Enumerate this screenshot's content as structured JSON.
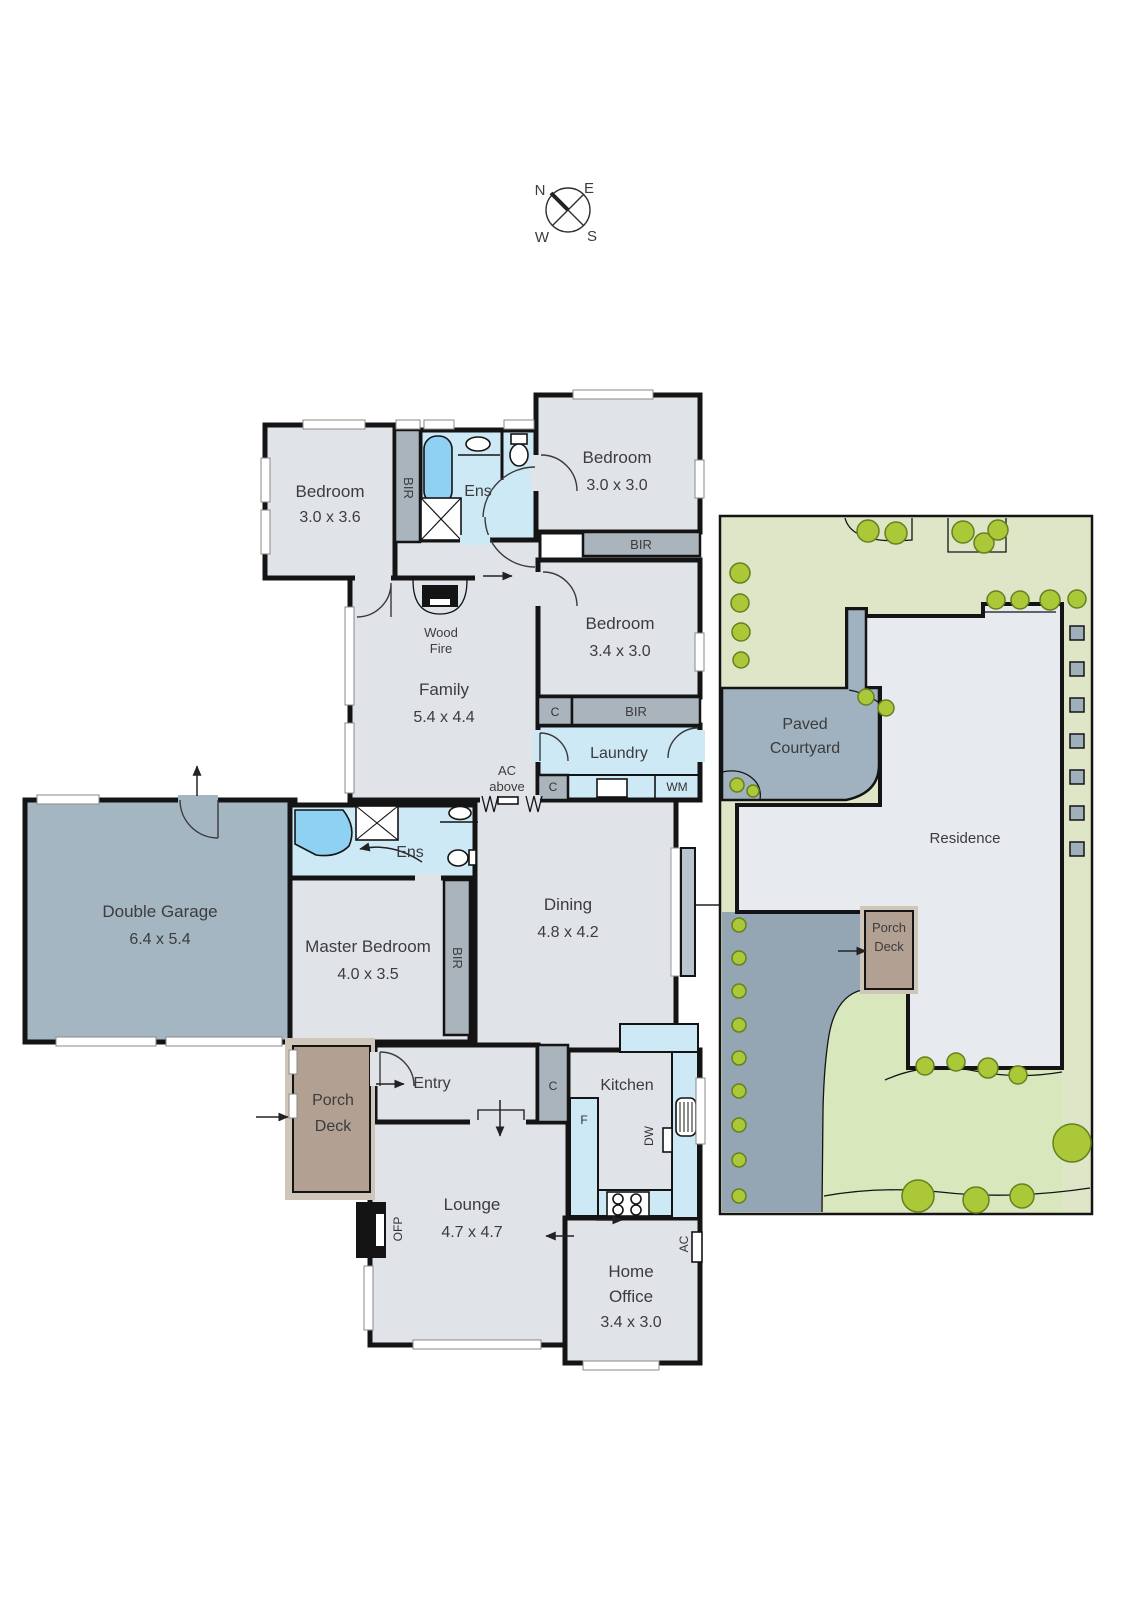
{
  "compass": {
    "n": "N",
    "e": "E",
    "w": "W",
    "s": "S"
  },
  "floor_plan": {
    "rooms": {
      "bedroom1": {
        "name": "Bedroom",
        "dims": "3.0 x 3.6"
      },
      "bedroom2": {
        "name": "Bedroom",
        "dims": "3.0 x 3.0"
      },
      "bedroom3": {
        "name": "Bedroom",
        "dims": "3.4 x 3.0"
      },
      "family": {
        "name": "Family",
        "dims": "5.4 x 4.4"
      },
      "laundry": {
        "name": "Laundry"
      },
      "double_garage": {
        "name": "Double Garage",
        "dims": "6.4 x 5.4"
      },
      "master_bedroom": {
        "name": "Master Bedroom",
        "dims": "4.0 x 3.5"
      },
      "dining": {
        "name": "Dining",
        "dims": "4.8 x 4.2"
      },
      "kitchen": {
        "name": "Kitchen"
      },
      "entry": {
        "name": "Entry"
      },
      "lounge": {
        "name": "Lounge",
        "dims": "4.7 x 4.7"
      },
      "home_office": {
        "line1": "Home",
        "line2": "Office",
        "dims": "3.4 x 3.0"
      },
      "porch_deck": {
        "line1": "Porch",
        "line2": "Deck"
      },
      "ensuite1": {
        "name": "Ens"
      },
      "ensuite_master": {
        "name": "Ens"
      }
    },
    "labels": {
      "bir": "BIR",
      "cupboard": "C",
      "wm": "WM",
      "fridge": "F",
      "dw": "DW",
      "ofp": "OFP",
      "ac": "AC",
      "wood_fire1": "Wood",
      "wood_fire2": "Fire",
      "ac_above1": "AC",
      "ac_above2": "above"
    }
  },
  "site_plan": {
    "courtyard_line1": "Paved",
    "courtyard_line2": "Courtyard",
    "residence": "Residence",
    "porch_line1": "Porch",
    "porch_line2": "Deck"
  },
  "colors": {
    "floor": "#e0e3e8",
    "wet_area": "#cde9f6",
    "fixture_blue": "#8ed1f2",
    "robe_grey": "#a9b4bd",
    "garage_grey": "#a5b6c3",
    "deck_brown": "#b2a093",
    "yard_green": "#dfe6c8",
    "lawn_green": "#d9e7bd",
    "tree_green": "#abc839",
    "paving_grey": "#a0b1bf",
    "wall": "#141414"
  }
}
